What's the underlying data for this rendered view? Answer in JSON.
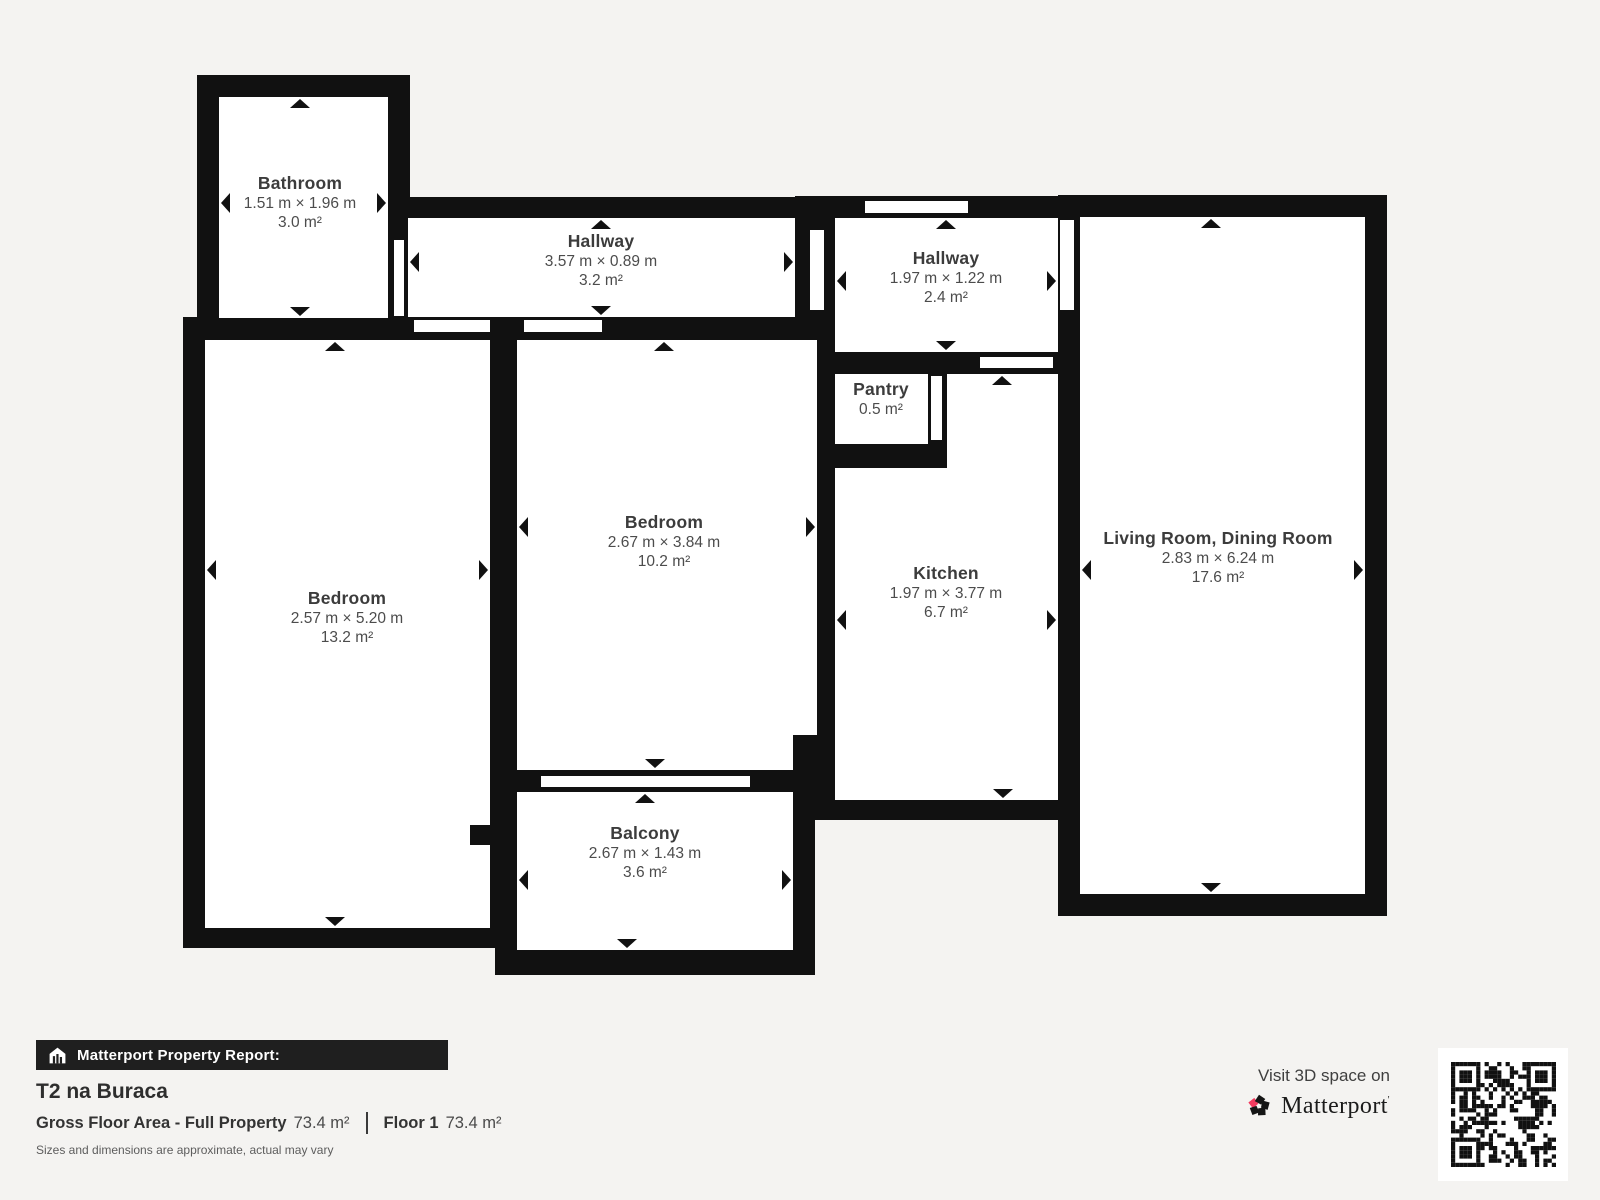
{
  "plan": {
    "rooms": [
      {
        "name": "Bathroom",
        "dims": "1.51 m × 1.96 m",
        "area": "3.0 m²"
      },
      {
        "name": "Hallway",
        "dims": "3.57 m × 0.89 m",
        "area": "3.2 m²"
      },
      {
        "name": "Hallway",
        "dims": "1.97 m × 1.22 m",
        "area": "2.4 m²"
      },
      {
        "name": "Pantry",
        "dims": "",
        "area": "0.5 m²"
      },
      {
        "name": "Bedroom",
        "dims": "2.67 m × 3.84 m",
        "area": "10.2 m²"
      },
      {
        "name": "Bedroom",
        "dims": "2.57 m × 5.20 m",
        "area": "13.2 m²"
      },
      {
        "name": "Kitchen",
        "dims": "1.97 m × 3.77 m",
        "area": "6.7 m²"
      },
      {
        "name": "Living Room, Dining Room",
        "dims": "2.83 m × 6.24 m",
        "area": "17.6 m²"
      },
      {
        "name": "Balcony",
        "dims": "2.67 m × 1.43 m",
        "area": "3.6 m²"
      }
    ]
  },
  "report": {
    "banner": "Matterport Property Report:",
    "property_name": "T2 na Buraca",
    "gross_label": "Gross Floor Area - Full Property",
    "gross_value": "73.4 m²",
    "floor_label": "Floor 1",
    "floor_value": "73.4 m²",
    "disclaimer": "Sizes and dimensions are approximate, actual may vary"
  },
  "cta": {
    "visit_text": "Visit 3D space on",
    "brand": "Matterport",
    "brand_mark": "'"
  },
  "icons": {
    "banner_icon": "house-chart-icon",
    "logo_icon": "matterport-pinwheel-icon",
    "qr": "qr-code"
  },
  "colors": {
    "wall": "#111111",
    "room_fill": "#ffffff",
    "background": "#f4f3f1",
    "accent_pink": "#f23b5f",
    "banner_bg": "#1f1f1f"
  }
}
